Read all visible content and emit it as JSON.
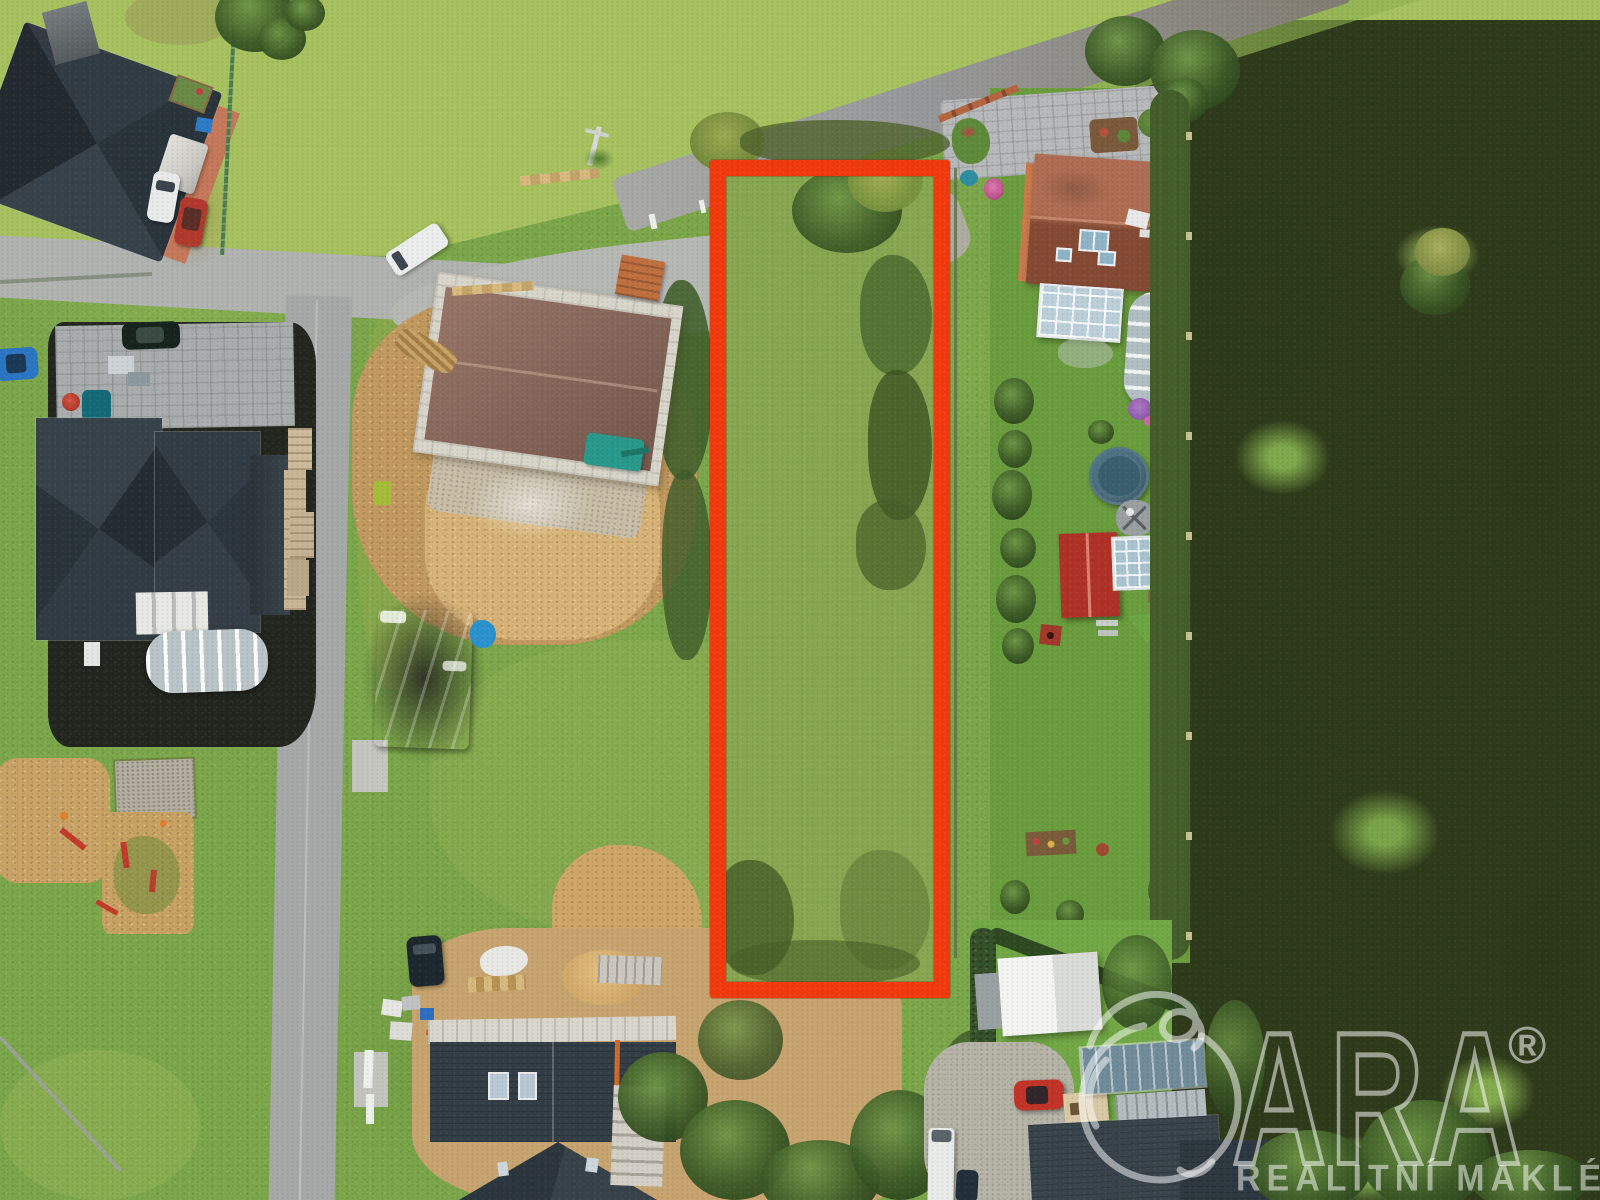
{
  "photo": {
    "kind": "aerial-drone-view of residential plots, one land parcel highlighted",
    "highlight_outline_color": "#f13a0e",
    "palette": {
      "grass": "#7ca74a",
      "meadow_in_plot": "#73a440",
      "scrubland": "#6d7742",
      "asphalt_road": "#9a9ea0",
      "concrete_plaza": "#b6b8b4",
      "construction_dirt": "#c49c62",
      "dark_roof": "#2e3941",
      "terracotta_roof": "#a15a40",
      "blue_tarp": "#1d91d4"
    }
  },
  "watermark": {
    "logo_icon": "apple-outline-icon",
    "brand_letters": "ARA",
    "registered_symbol": "®",
    "tagline": "REALITNÍ MAKLÉŘI",
    "color": "#ffffff",
    "opacity": 0.5
  }
}
